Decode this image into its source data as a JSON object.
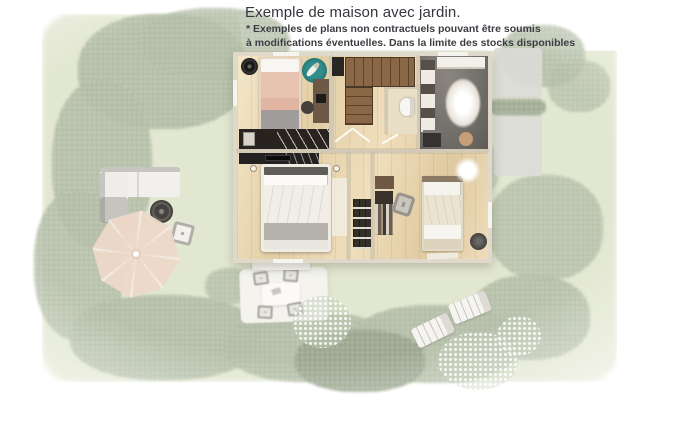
{
  "header": {
    "title": "Exemple de maison avec jardin.",
    "disclaimer": {
      "line1": "* Exemples de plans non contractuels pouvant être soumis",
      "line2": "à modifications éventuelles. Dans la limite des stocks disponibles"
    }
  },
  "scene": {
    "type": "aerial-3d-render-of-house-floor-plan-with-garden",
    "house_rooms": [
      "bedroom-1",
      "staircase",
      "wc",
      "bathroom",
      "master-bedroom",
      "bedroom-2",
      "hallway"
    ],
    "garden_elements": [
      "lawn",
      "tree-and-hedge-border",
      "outdoor-sofa",
      "fire-pit-table",
      "garden-chair",
      "parasol",
      "terrace-dining-set",
      "flower-bushes",
      "sun-loungers",
      "driveway",
      "porch-step"
    ]
  },
  "colors": {
    "text": "#35363c",
    "grass": "#e4e9d3",
    "foliage": "#aeb9a1",
    "foliage_dark": "#95a28a",
    "wall": "#e0d9cb",
    "wood": "#ecddbe",
    "stair": "#816244",
    "dark": "#2a2622",
    "bath_floor": "#716d68",
    "teal": "#2f8e8c",
    "salmon": "#e9c3b2",
    "parasol": "#ecd8c9",
    "terrace": "#f4f3ee",
    "drive": "#dcdbd6"
  }
}
